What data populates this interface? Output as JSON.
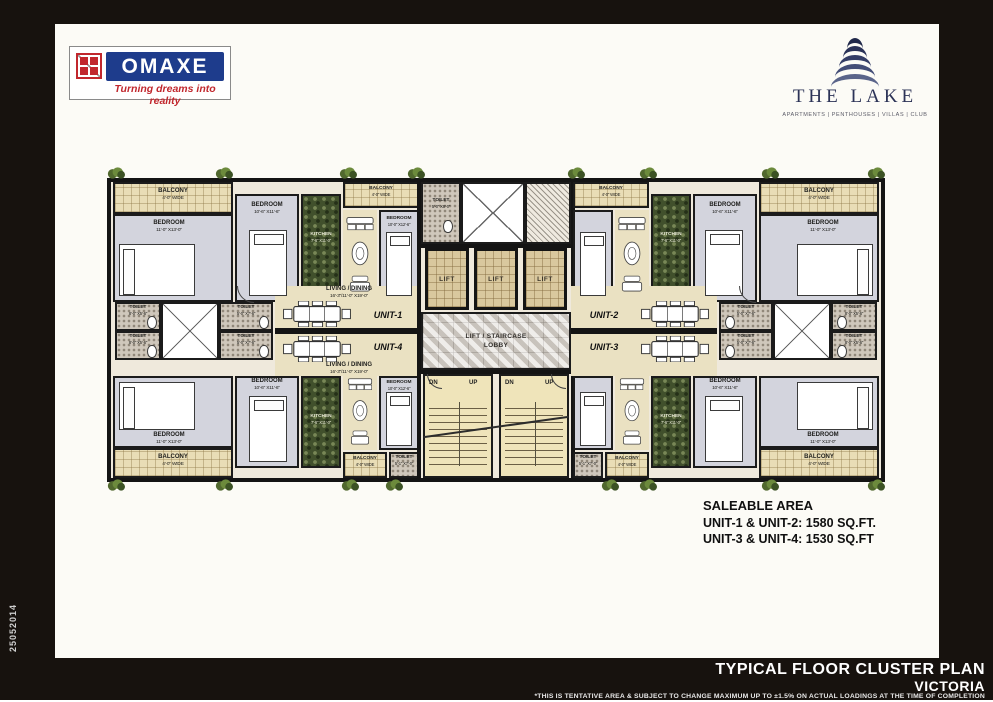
{
  "side_code": "25052014",
  "branding": {
    "omaxe_name": "OMAXE",
    "omaxe_tagline": "Turning dreams into reality",
    "lake_name": "THE LAKE",
    "lake_categories": "APARTMENTS | PENTHOUSES | VILLAS | CLUB"
  },
  "plan": {
    "units": {
      "u1": "UNIT-1",
      "u2": "UNIT-2",
      "u3": "UNIT-3",
      "u4": "UNIT-4"
    },
    "rooms": {
      "balcony": "BALCONY",
      "balcony_dims": "4'-0\" WIDE",
      "bedroom": "BEDROOM",
      "bedroom_a_dims": "11'-0\" X13'-0\"",
      "bedroom_b_dims": "10'-6\" X11'-6\"",
      "bedroom_c_dims": "10'-0\" X12'-6\"",
      "kitchen": "KITCHEN",
      "kitchen_dims": "7'-6\" X11'-0\"",
      "living": "LIVING / DINING",
      "living_dims": "16'-3\"/11'-0\" X19'-0\"",
      "toilet": "TOILET",
      "toilet_dims_a": "8'-0\" X5'-6\"",
      "toilet_dims_b": "5'-0\" X7'-6\"",
      "toilet_dims_c": "5'-0\" X8'-0\"",
      "toilet_dims_d": "5'-1\" X7'-0\"",
      "lift": "LIFT",
      "lobby_l1": "LIFT / STAIRCASE",
      "lobby_l2": "LOBBY",
      "up": "UP",
      "dn": "DN"
    }
  },
  "saleable": {
    "title": "SALEABLE AREA",
    "unit12": "UNIT-1 & UNIT-2: 1580 SQ.FT.",
    "unit34": "UNIT-3 & UNIT-4: 1530 SQ.FT"
  },
  "footer": {
    "title": "TYPICAL FLOOR CLUSTER PLAN",
    "project": "VICTORIA",
    "disclaimer": "*THIS IS TENTATIVE AREA & SUBJECT TO CHANGE MAXIMUM UP TO ±1.5% ON ACTUAL  LOADINGS AT THE TIME OF COMPLETION"
  },
  "colors": {
    "omaxe_blue": "#1e3c8c",
    "omaxe_red": "#c1272d",
    "lake_navy": "#2c3357",
    "sheet": "#fcfbf6",
    "page_bg": "#17120e"
  }
}
